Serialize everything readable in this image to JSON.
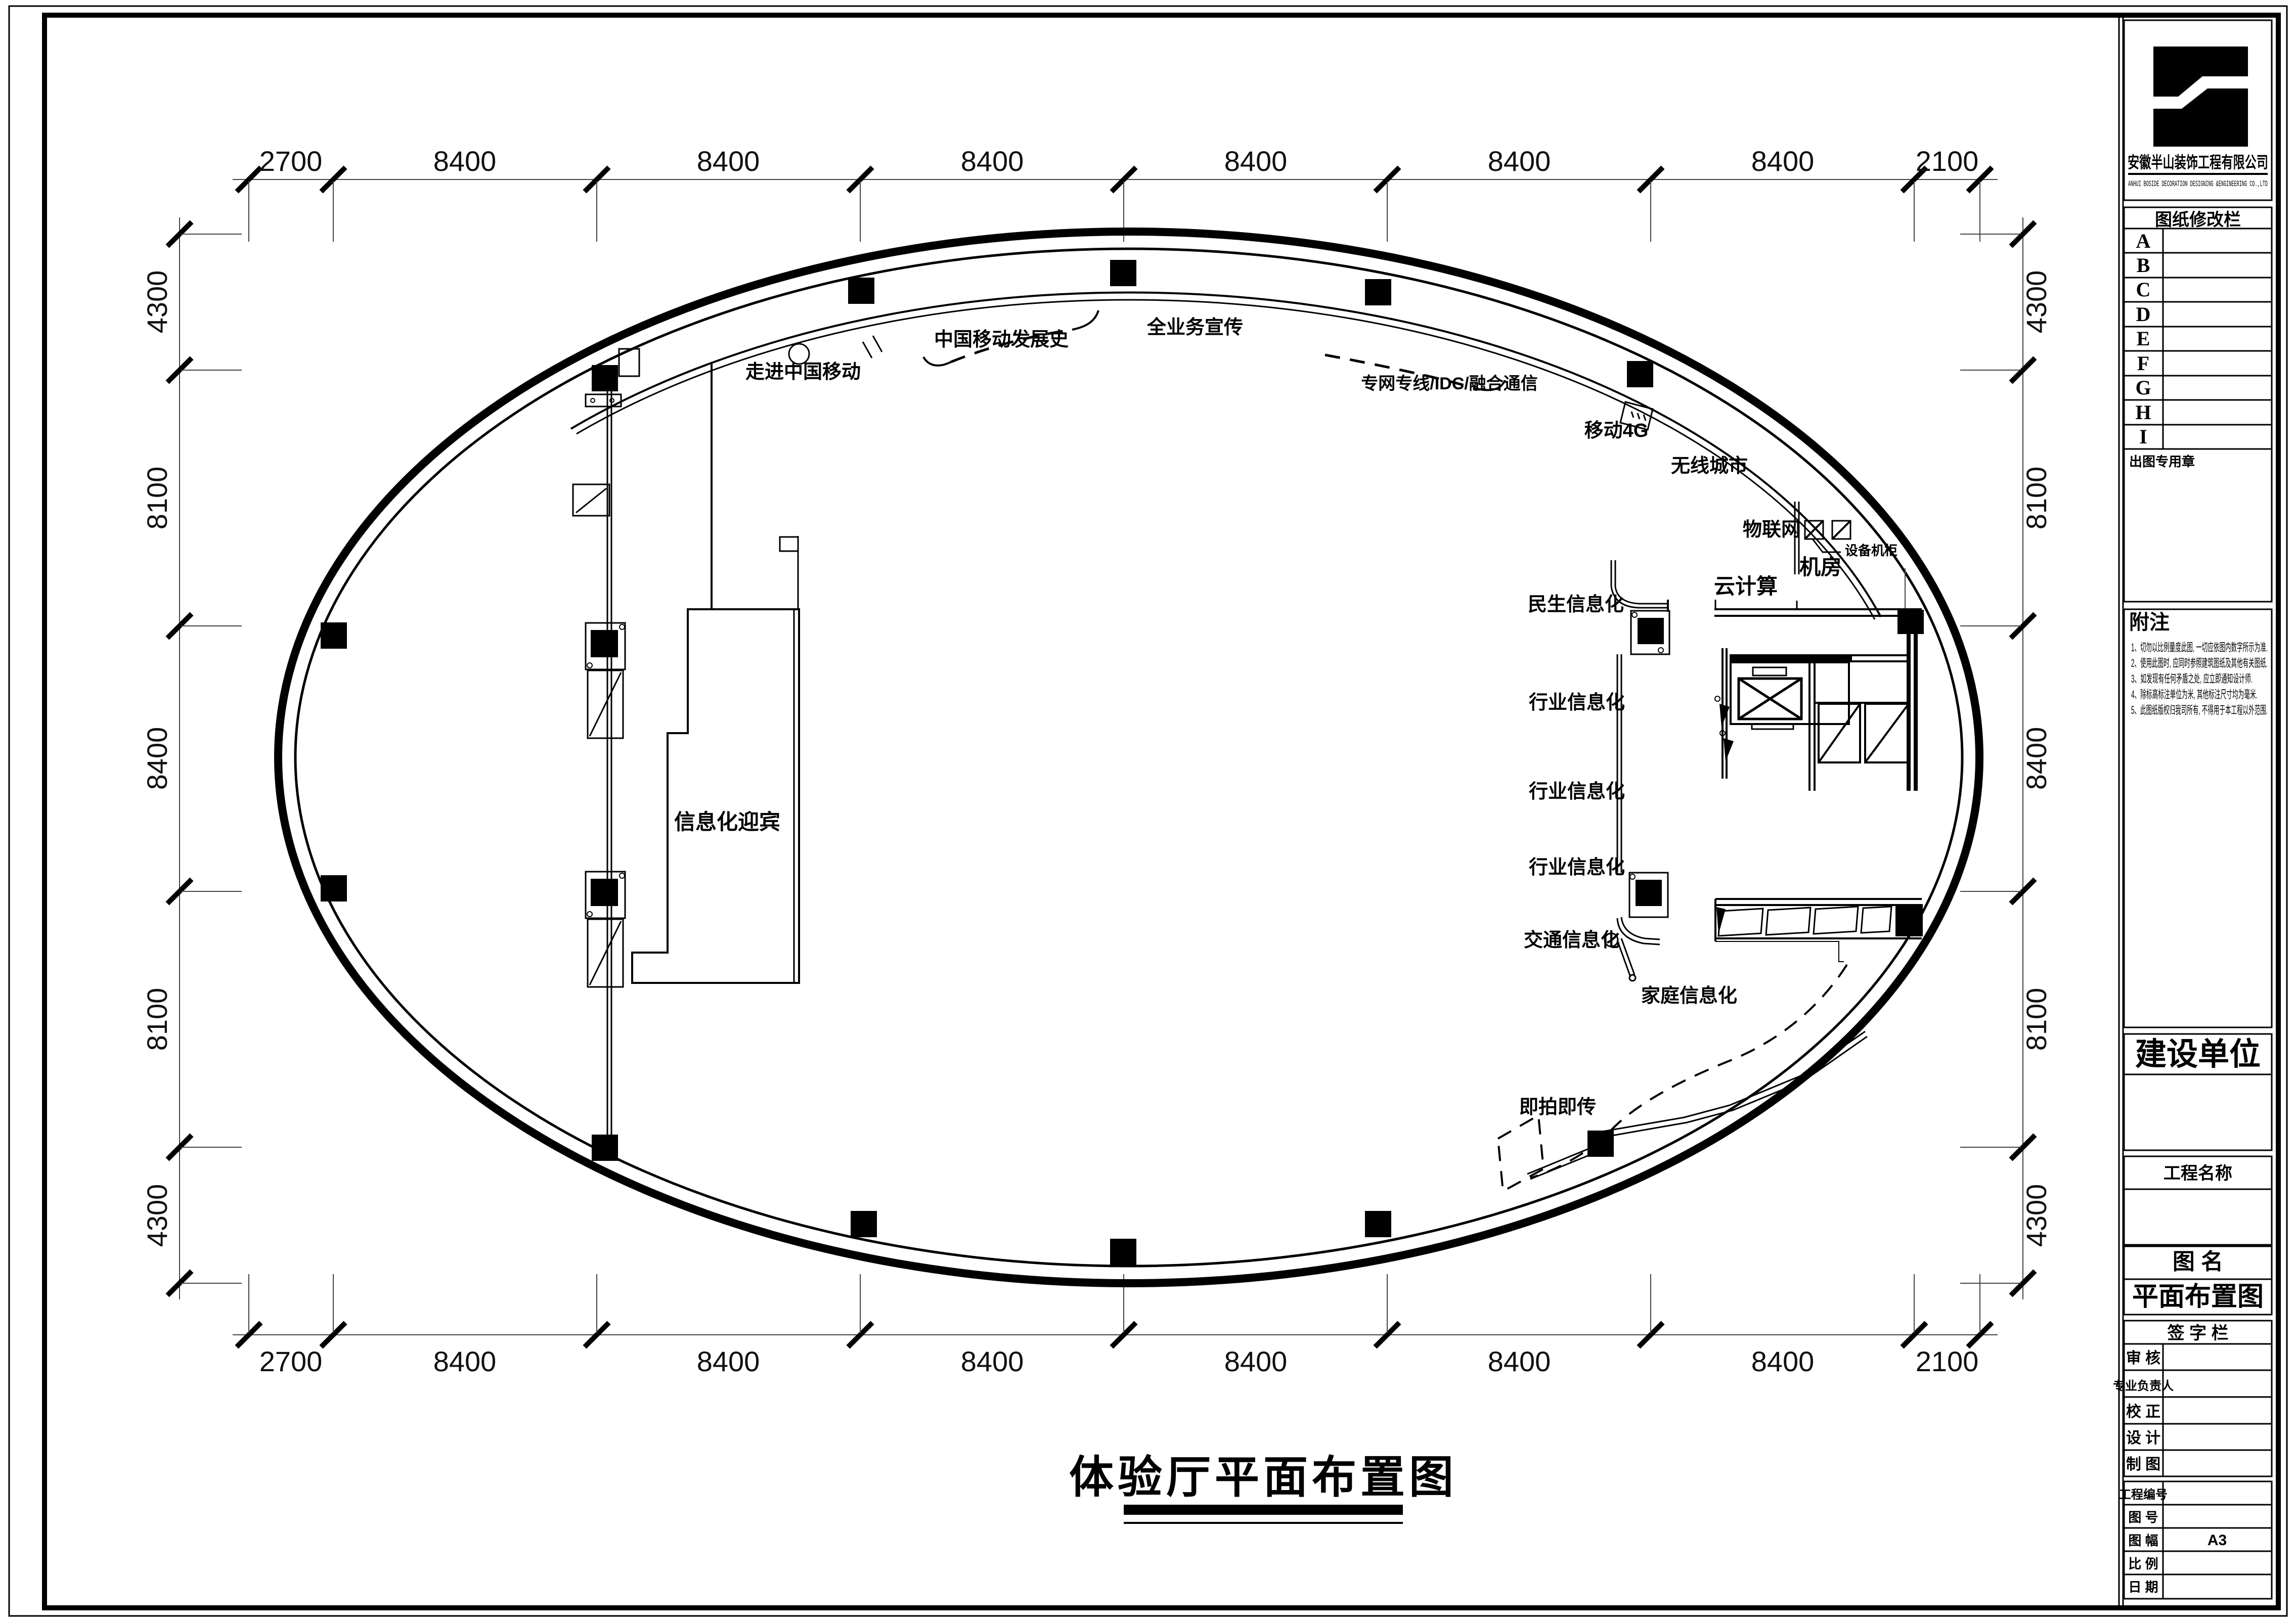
{
  "doc": {
    "main_title": "体验厅平面布置图",
    "sheet_size": "A3"
  },
  "dims": {
    "top": [
      "2700",
      "8400",
      "8400",
      "8400",
      "8400",
      "8400",
      "8400",
      "2100"
    ],
    "bottom": [
      "2700",
      "8400",
      "8400",
      "8400",
      "8400",
      "8400",
      "8400",
      "2100"
    ],
    "left": [
      "4300",
      "8100",
      "8400",
      "8100",
      "4300"
    ],
    "right": [
      "4300",
      "8100",
      "8400",
      "8100",
      "4300"
    ]
  },
  "plan": {
    "labels": {
      "walk_in": "走进中国移动",
      "history": "中国移动发展史",
      "full_service": "全业务宣传",
      "private_line": "专网专线/IDC/融合通信",
      "mobile4g": "移动4G",
      "wireless_city": "无线城市",
      "iot": "物联网",
      "equipment_cabinet": "设备机柜",
      "machine_room": "机房",
      "cloud": "云计算",
      "minsheng": "民生信息化",
      "industry1": "行业信息化",
      "industry2": "行业信息化",
      "industry3": "行业信息化",
      "traffic": "交通信息化",
      "family": "家庭信息化",
      "instant": "即拍即传",
      "welcome": "信息化迎宾"
    }
  },
  "title_block": {
    "company_cn": "安徽半山装饰工程有限公司",
    "company_en": "ANHUI BOSIDE DECORATION DESIGNING &ENGINEERING CO.,LTD",
    "revision_header": "图纸修改栏",
    "revision_rows": [
      "A",
      "B",
      "C",
      "D",
      "E",
      "F",
      "G",
      "H",
      "I"
    ],
    "seal": "出图专用章",
    "notes_header": "附注",
    "notes": [
      "1、切勿以比例量度此图, 一切应依图内数字所示为准.",
      "2、使用此图时, 应同时参照建筑图纸及其他有关图纸.",
      "3、如发现有任何矛盾之处, 应立即通知设计师.",
      "4、除标高标注单位为米, 其他标注尺寸均为毫米.",
      "5、此图纸版权归我司所有, 不得用于本工程以外范围."
    ],
    "construction_unit": "建设单位",
    "project_name": "工程名称",
    "drawing_name_label": "图    名",
    "drawing_name": "平面布置图",
    "signature_header": "签 字 栏",
    "sig_rows": [
      "审    核",
      "专业负责人",
      "校    正",
      "设    计",
      "制    图"
    ],
    "info_rows": [
      {
        "label": "工程编号",
        "value": ""
      },
      {
        "label": "图    号",
        "value": ""
      },
      {
        "label": "图    幅",
        "value": "A3"
      },
      {
        "label": "比    例",
        "value": ""
      },
      {
        "label": "日    期",
        "value": ""
      }
    ]
  }
}
